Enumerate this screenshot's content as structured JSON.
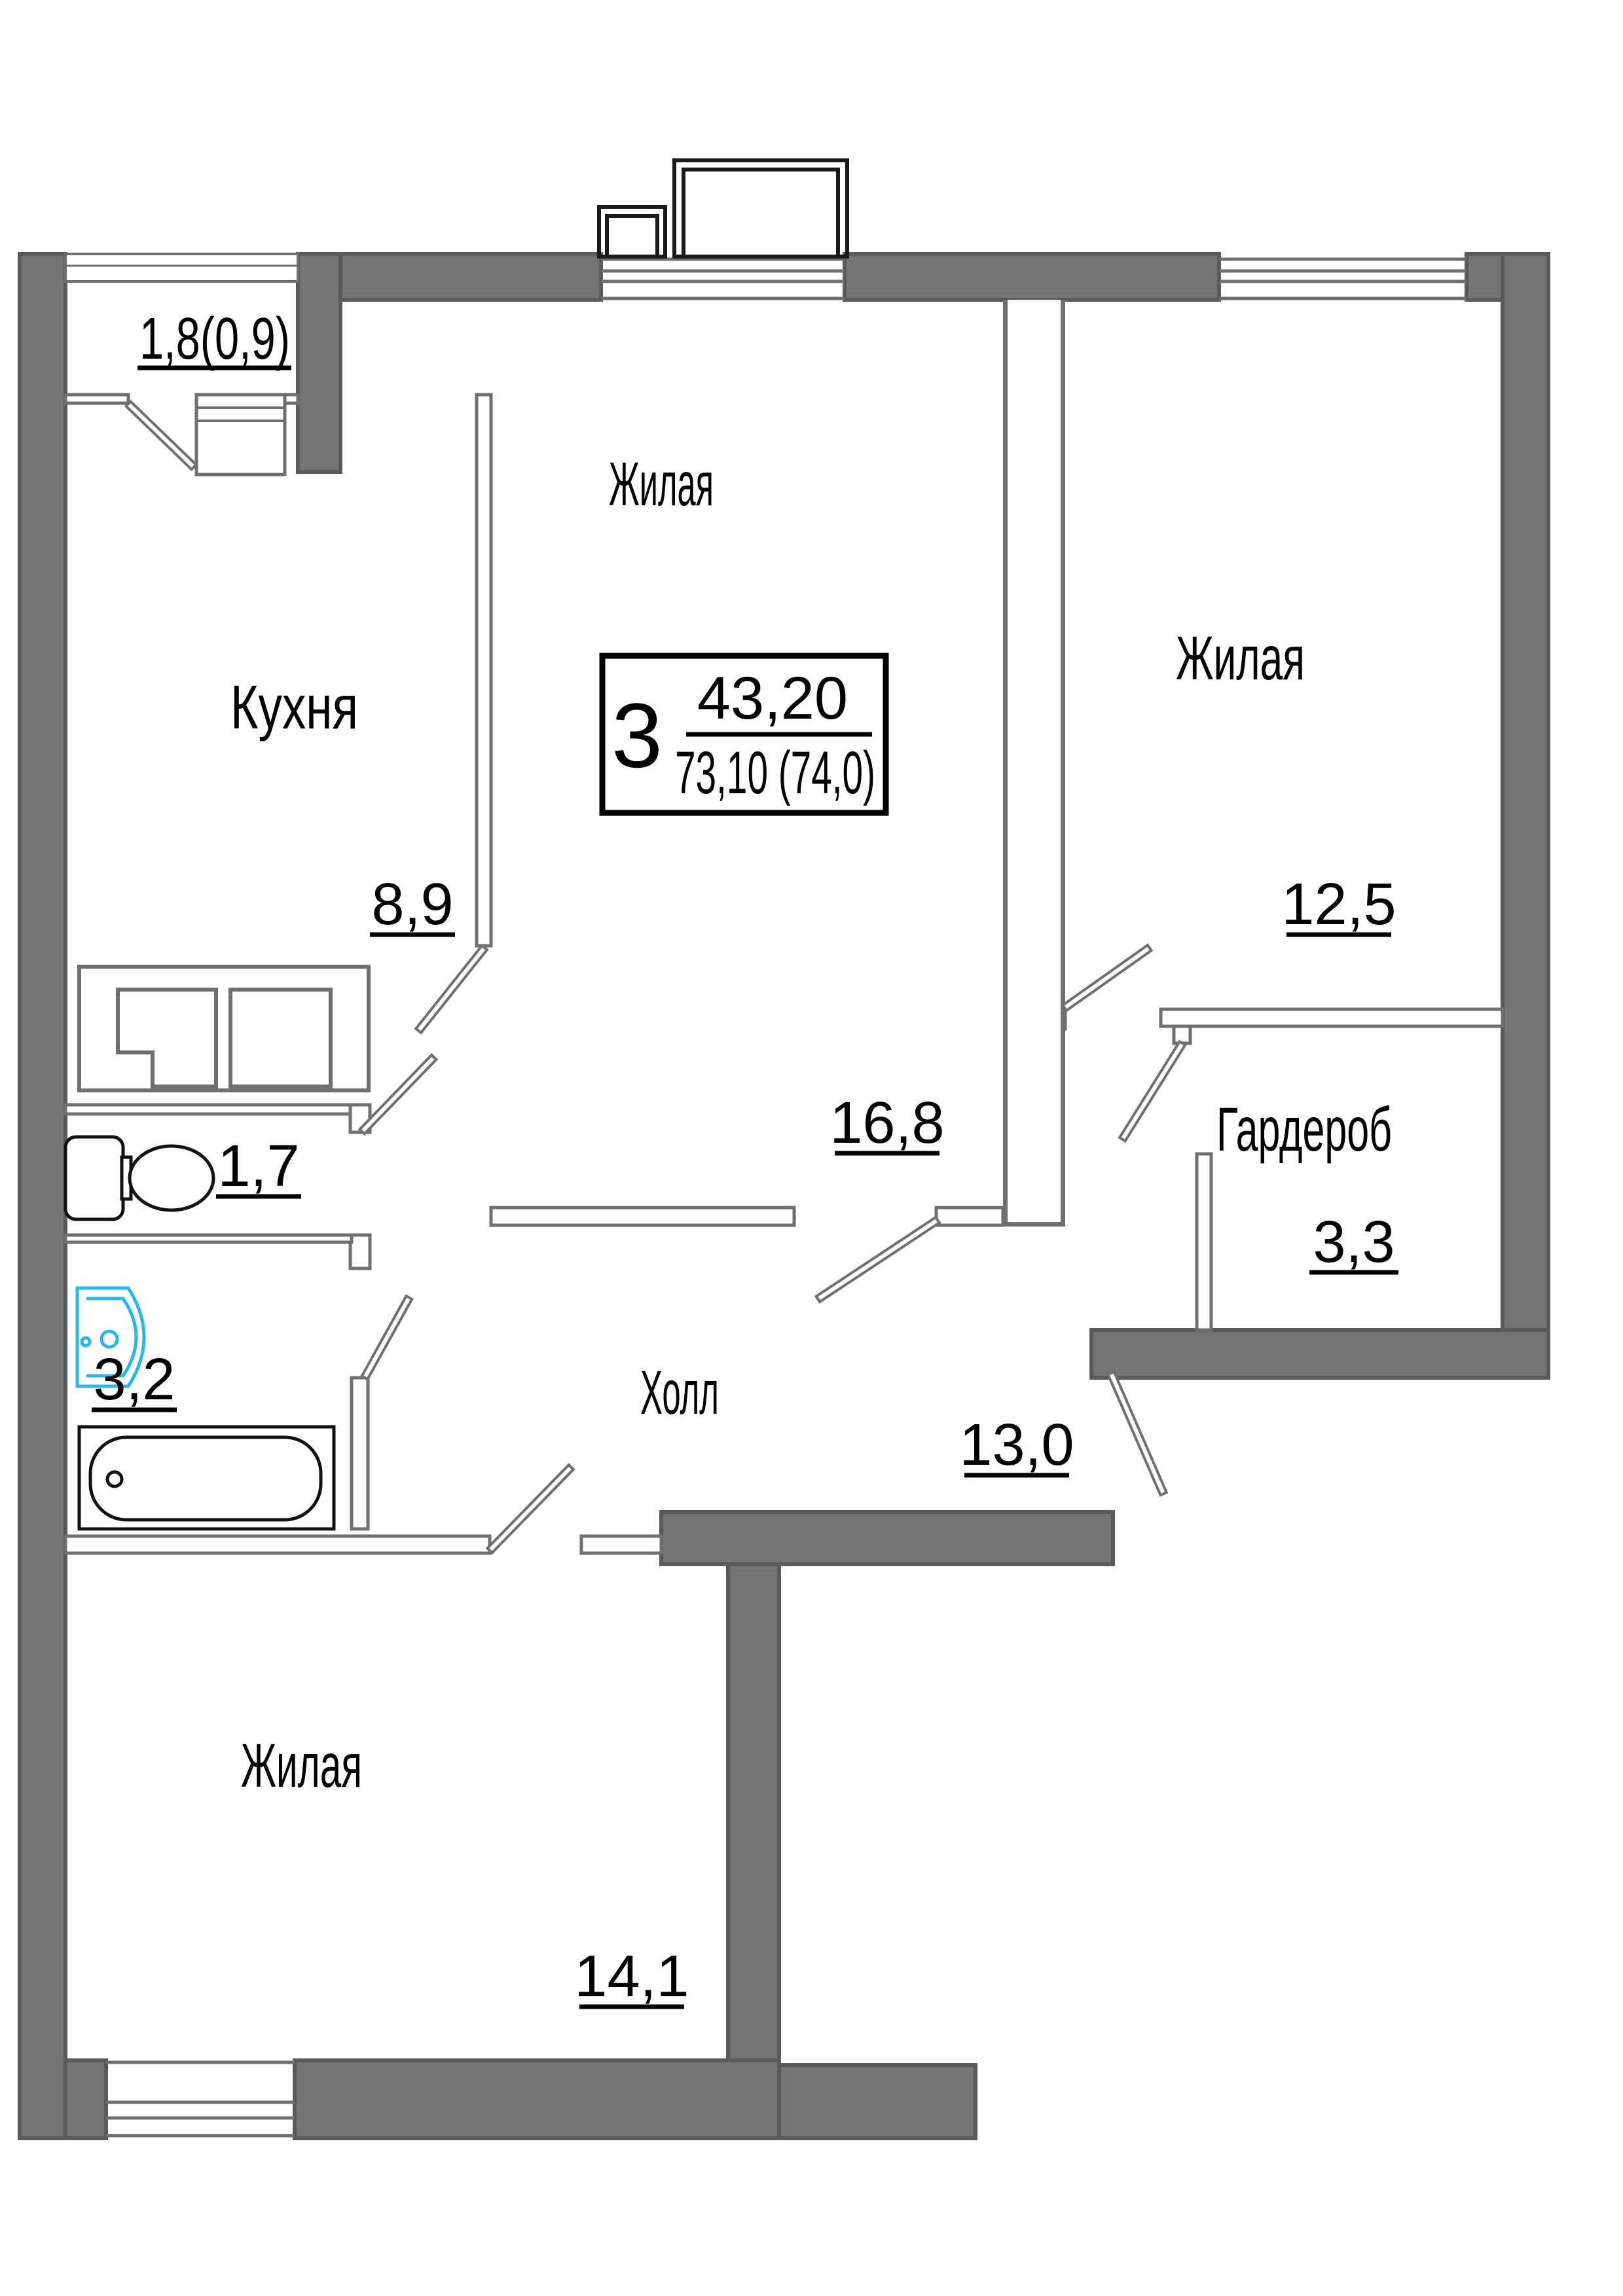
{
  "plan": {
    "type": "apartment_floor_plan",
    "unit": {
      "number_of_rooms": "3",
      "living_area": "43,20",
      "total_area": "73,10 (74,0)"
    },
    "rooms": [
      {
        "name": "balcony",
        "label": "",
        "area": "1,8(0,9)"
      },
      {
        "name": "kitchen",
        "label": "Кухня",
        "area": "8,9"
      },
      {
        "name": "living-top",
        "label": "Жилая",
        "area": "16,8"
      },
      {
        "name": "living-right",
        "label": "Жилая",
        "area": "12,5"
      },
      {
        "name": "wardrobe",
        "label": "Гардероб",
        "area": "3,3"
      },
      {
        "name": "wc",
        "label": "",
        "area": "1,7"
      },
      {
        "name": "bathroom",
        "label": "",
        "area": "3,2"
      },
      {
        "name": "hall",
        "label": "Холл",
        "area": "13,0"
      },
      {
        "name": "living-bottom",
        "label": "Жилая",
        "area": "14,1"
      }
    ],
    "colors": {
      "wall": "#747474",
      "wall_edge": "#5a5a5a",
      "thin_line": "#6f6f6f",
      "text": "#000000",
      "sink_accent": "#29b7e9"
    }
  }
}
